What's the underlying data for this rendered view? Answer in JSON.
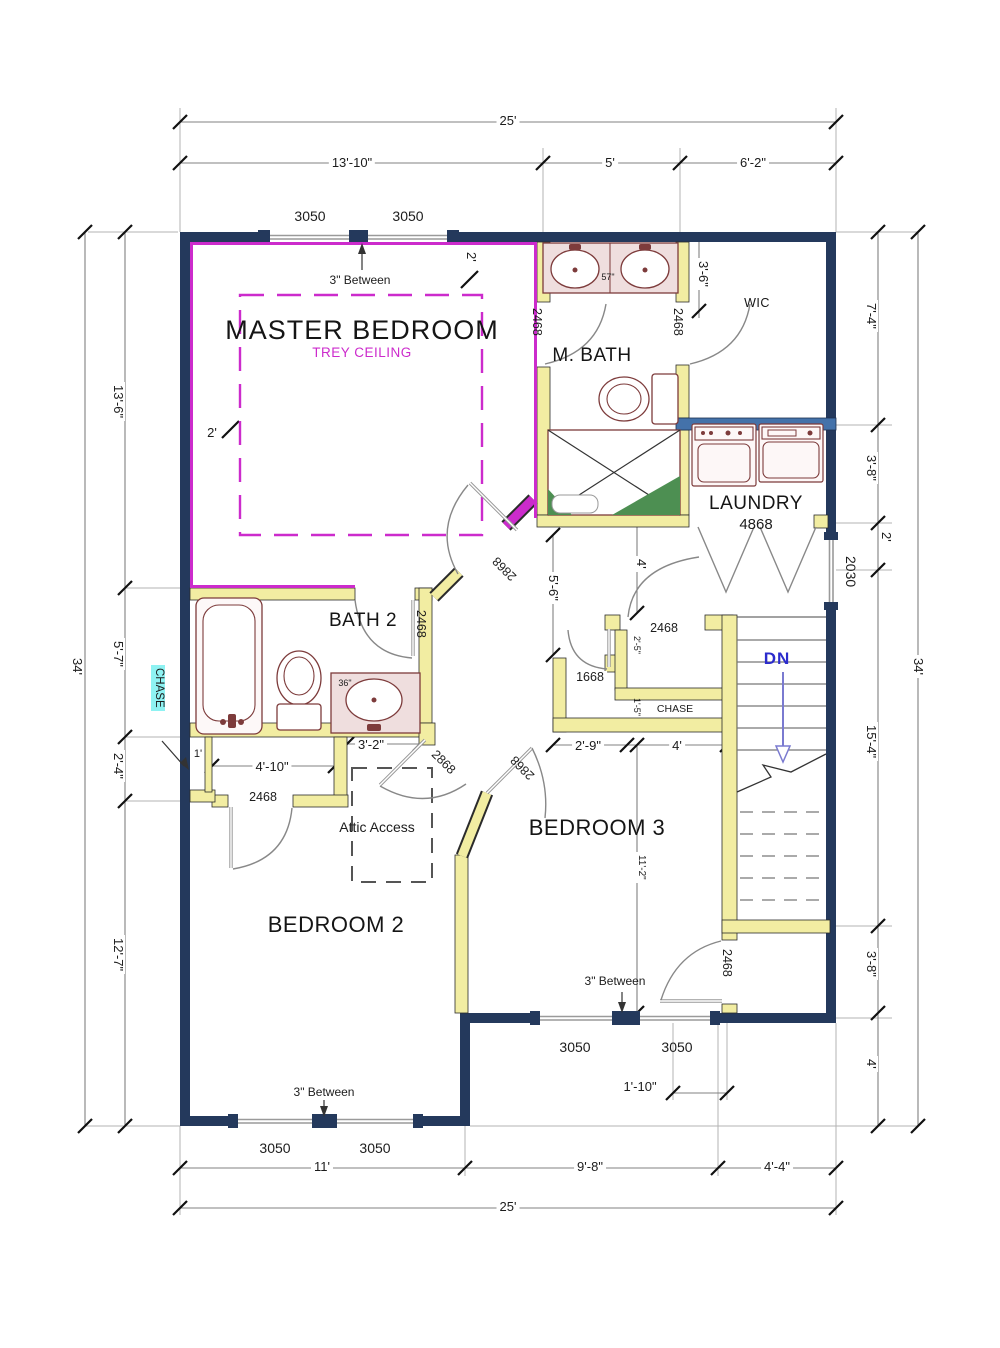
{
  "rooms": {
    "master": "MASTER BEDROOM",
    "trey": "TREY CEILING",
    "mbath": "M. BATH",
    "wic": "WIC",
    "laundry": "LAUNDRY",
    "bath2": "BATH 2",
    "bedroom2": "BEDROOM 2",
    "bedroom3": "BEDROOM 3",
    "chase_left": "CHASE",
    "chase_mid": "CHASE",
    "attic": "Attic Access",
    "dn": "DN"
  },
  "doors": {
    "master_entry": "2868",
    "bedroom2_entry": "2868",
    "bedroom3_entry": "2868",
    "master_bath": "2468",
    "wic": "2468",
    "bath2": "2468",
    "bedroom2_closet": "2468",
    "hall_closet": "2468",
    "linen": "1668",
    "bedroom3_rear": "2468",
    "laundry": "4868"
  },
  "windows": {
    "master_w1": "3050",
    "master_w2": "3050",
    "b2_w1": "3050",
    "b2_w2": "3050",
    "b3_w1": "3050",
    "b3_w2": "3050",
    "hall": "2030",
    "note_master": "3\" Between",
    "note_b2": "3\" Between",
    "note_b3": "3\" Between"
  },
  "dims": {
    "top_overall": "25'",
    "top_master": "13'-10\"",
    "top_mbath": "5'",
    "top_wic": "6'-2\"",
    "left_overall": "34'",
    "left1": "13'-6\"",
    "left2": "5'-7\"",
    "left3": "2'-4\"",
    "left4": "12'-7\"",
    "right_overall": "34'",
    "right1": "7'-4\"",
    "right2": "3'-8\"",
    "right3": "2'",
    "right4": "15'-4\"",
    "right5": "3'-8\"",
    "right6": "4'",
    "bottom_overall": "25'",
    "bottom_b2": "11'",
    "bottom_b3": "9'-8\"",
    "bottom_stair": "4'-4\"",
    "trey_left": "2'",
    "trey_top": "2'",
    "wic_entry": "3'-6\"",
    "hall_a": "5'-6\"",
    "hall_b": "4'",
    "closet_a": "2'-5\"",
    "chase_a": "1'-5\"",
    "hall_c": "2'-9\"",
    "hall_d": "4'",
    "bath2_a": "3'-2\"",
    "closet_b": "4'-10\"",
    "chase_b": "1'",
    "b3_a": "11'-2\"",
    "b3_b": "1'-10\""
  },
  "fixtures": {
    "mbath_vanity": "57\"",
    "bath2_vanity": "36\""
  },
  "colors": {
    "ext": "#24395c",
    "int": "#f2eda2",
    "blue": "#4472aa",
    "trey": "#cc2bcc",
    "fixt": "#7d3b3b",
    "green": "#4d8f52",
    "cyan": "#8ef2f2",
    "dn": "#2b2bcc"
  }
}
